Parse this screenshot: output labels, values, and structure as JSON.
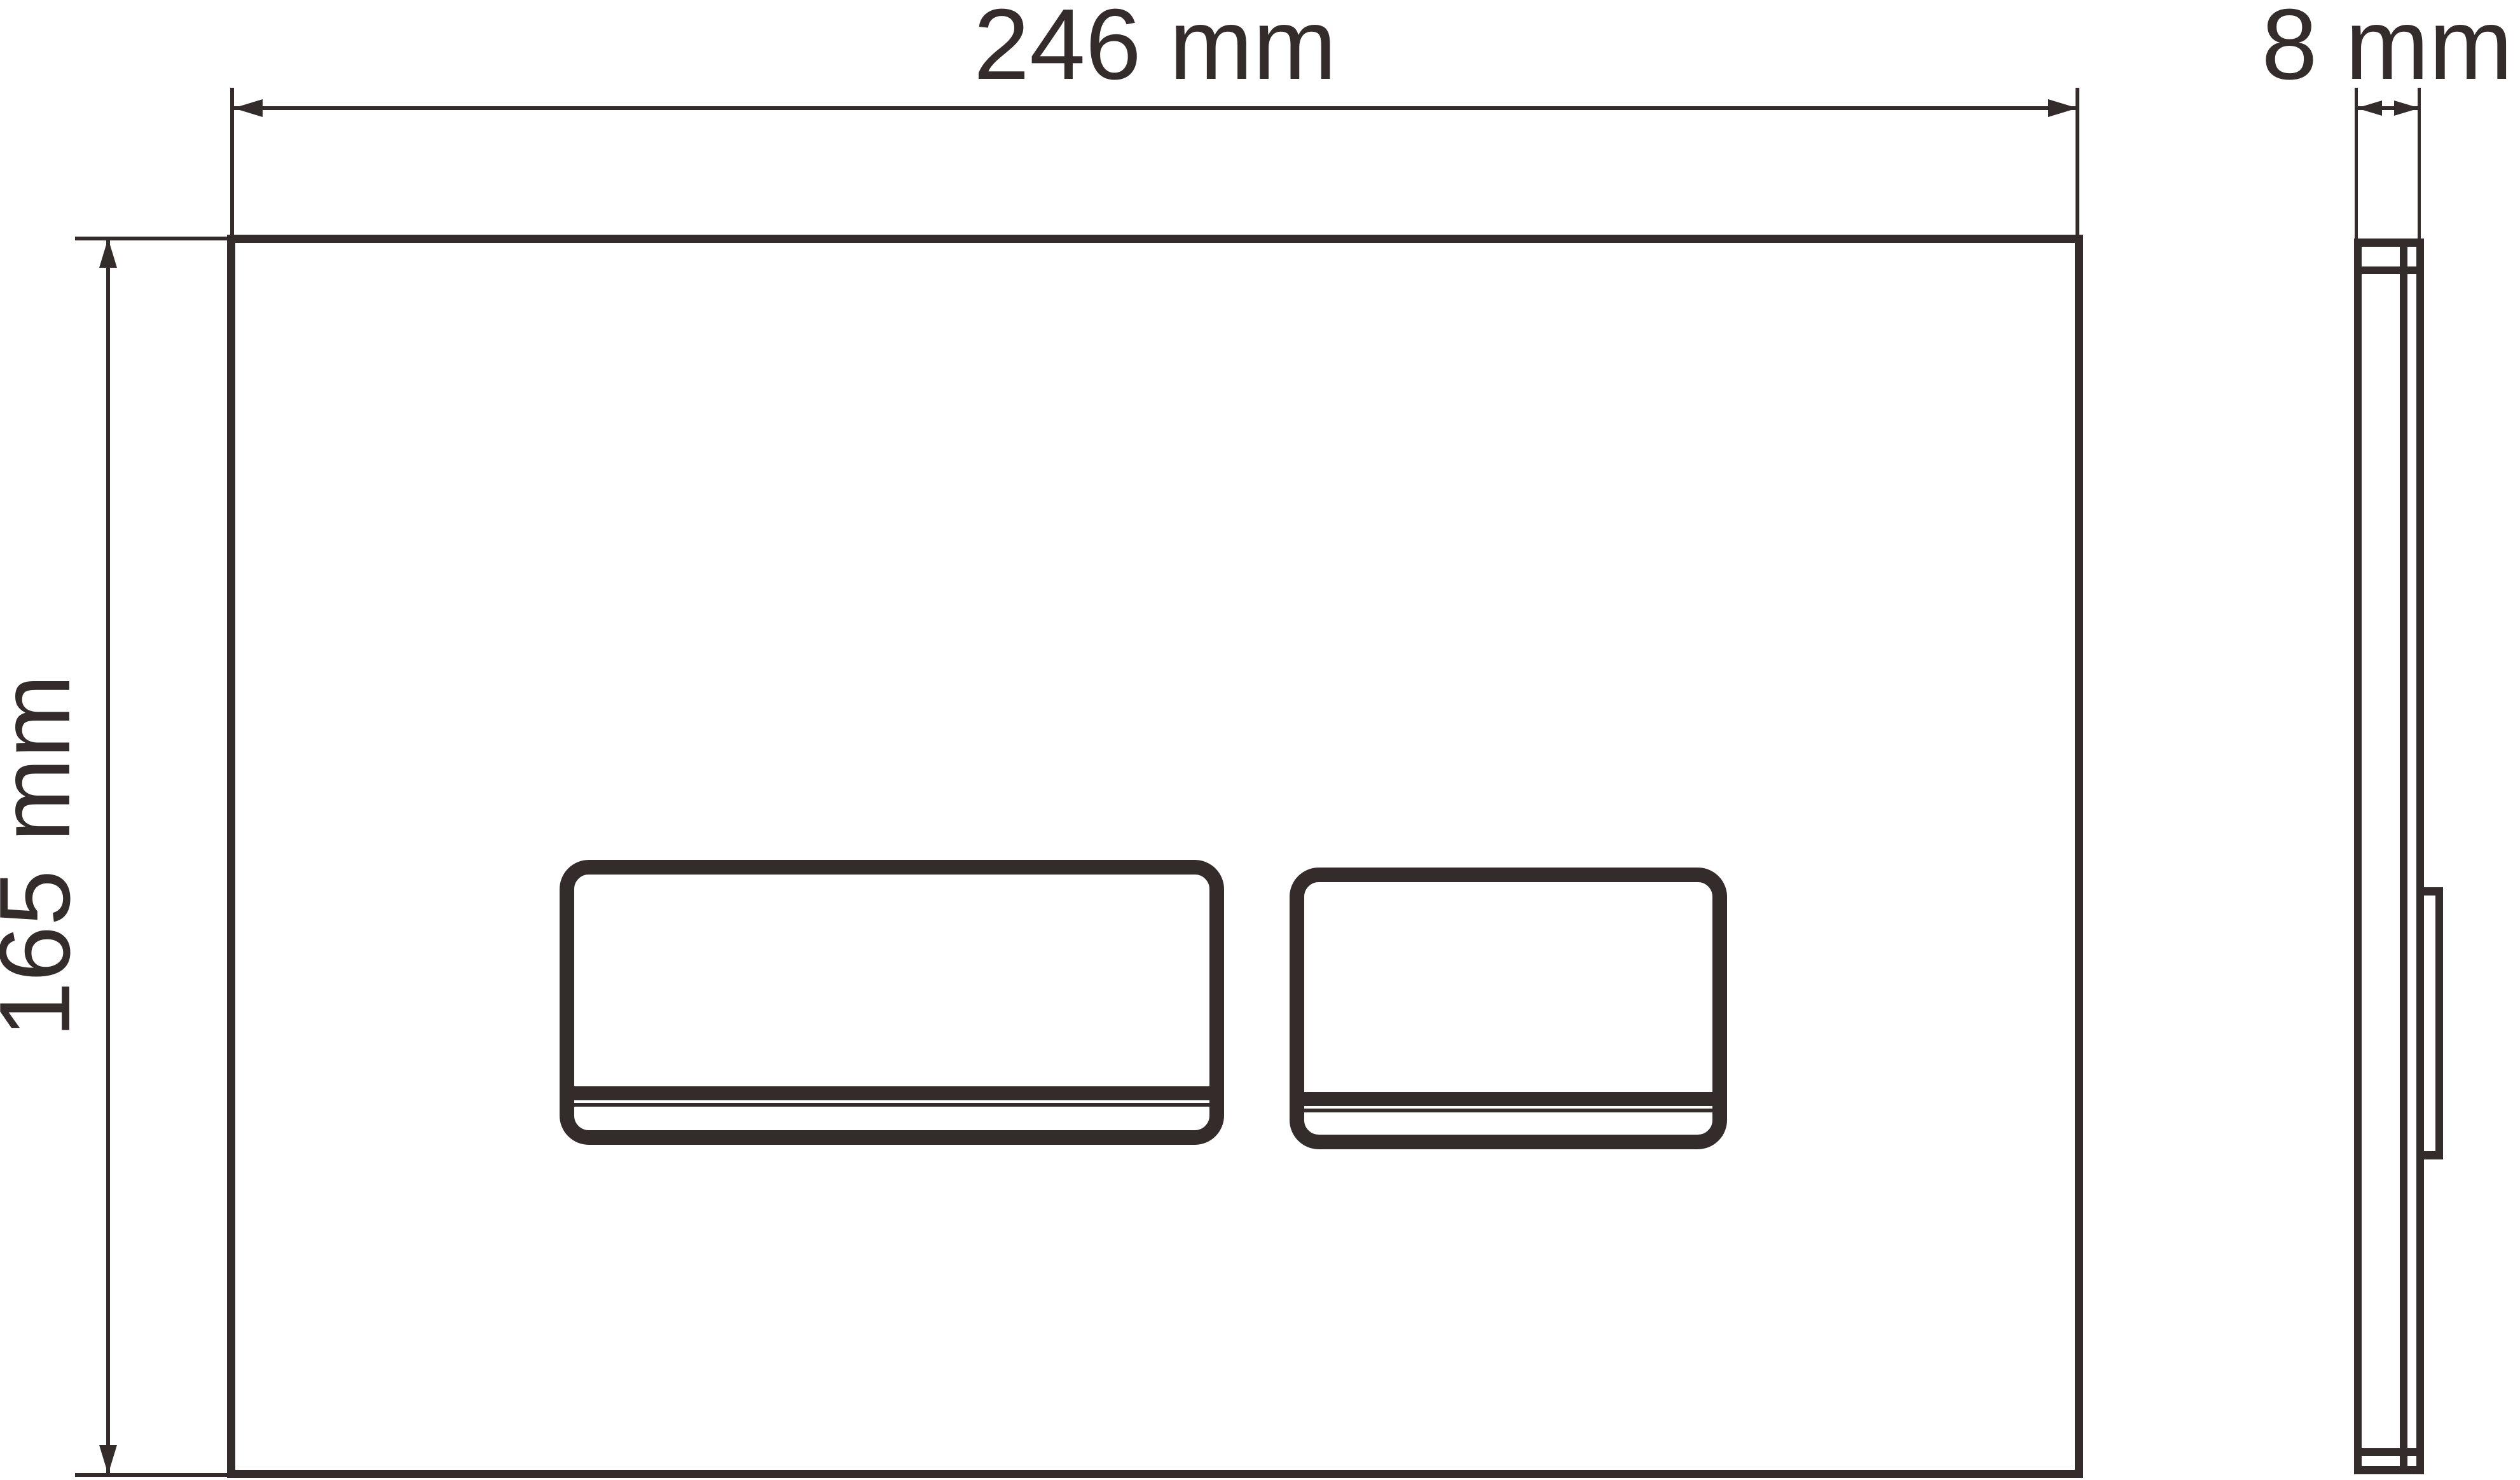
{
  "colors": {
    "line": "#342c2b",
    "background": "#ffffff"
  },
  "drawing": {
    "type": "technical-dimension-drawing",
    "views": [
      "front-view-flush-plate",
      "side-profile-view"
    ]
  },
  "dimensions": {
    "width": {
      "label": "246 mm",
      "value": 246,
      "unit": "mm"
    },
    "height": {
      "label": "165 mm",
      "value": 165,
      "unit": "mm"
    },
    "depth": {
      "label": "8 mm",
      "value": 8,
      "unit": "mm"
    }
  }
}
